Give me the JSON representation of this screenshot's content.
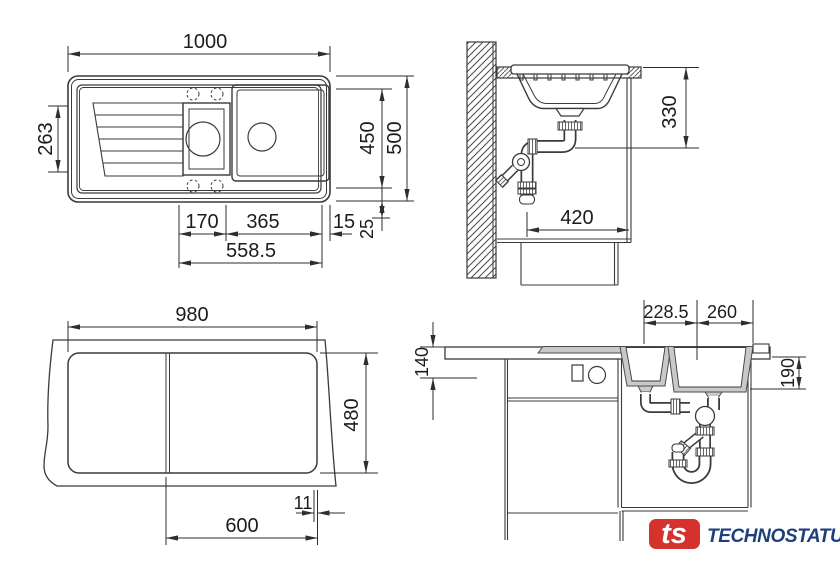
{
  "views": {
    "plan_top": {
      "dims": {
        "overall_width": "1000",
        "left_bowl_depth": "263",
        "bowl_area_depth": "450",
        "overall_depth": "500",
        "small_bowl_width": "170",
        "main_bowl_width": "365",
        "side_rim": "15",
        "front_rim": "25",
        "bowls_span": "558.5"
      }
    },
    "wall_section": {
      "dims": {
        "outlet_height": "330",
        "clear_depth": "420"
      }
    },
    "cutout_plan": {
      "dims": {
        "cutout_width": "980",
        "cutout_depth": "480",
        "corner_offset": "11",
        "base_cabinet_width": "600"
      }
    },
    "front_section": {
      "dims": {
        "small_bowl_offset": "228.5",
        "main_bowl_offset": "260",
        "worktop_drop": "140",
        "bowl_depth": "190"
      }
    }
  },
  "logo": {
    "monogram": "ts",
    "brand": "TECHNOSTATUS"
  },
  "colors": {
    "line": "#3a3a3a",
    "dimension_text": "#1c1c1c",
    "sink_material": "#c7cac9",
    "logo_red": "#d5322d",
    "logo_blue": "#1d3f7c",
    "background": "#ffffff"
  }
}
